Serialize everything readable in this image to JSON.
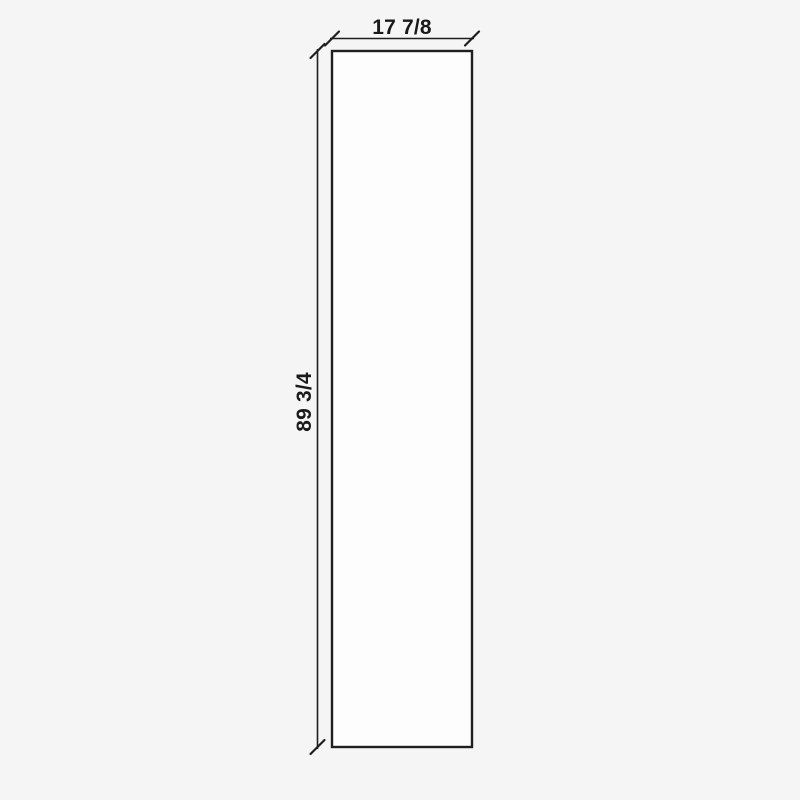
{
  "drawing": {
    "type": "panel-dimension-drawing",
    "width_label": "17 7/8",
    "height_label": "89 3/4",
    "colors": {
      "background": "#f5f5f6",
      "panel_fill": "#fdfdfd",
      "line": "#1f1f1f",
      "text": "#1a1a1a"
    }
  }
}
